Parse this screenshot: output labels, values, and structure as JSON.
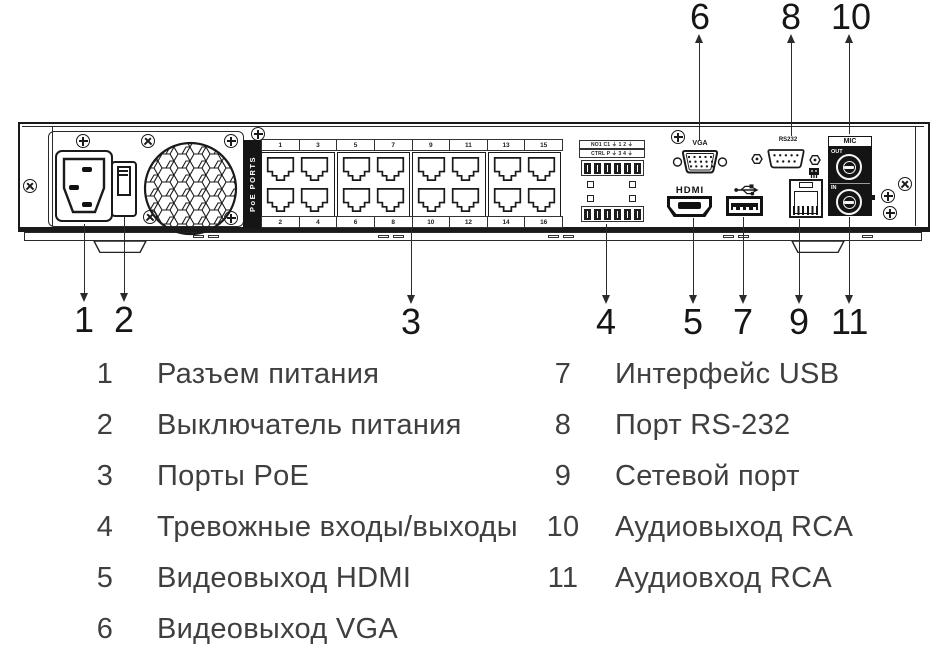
{
  "figure": {
    "type": "nvr-rear-panel-diagram",
    "device_labels": {
      "poe_ports": "PoE PORTS",
      "poe_top": [
        "1",
        "3",
        "5",
        "7",
        "9",
        "11",
        "13",
        "15"
      ],
      "poe_bottom": [
        "2",
        "4",
        "6",
        "8",
        "10",
        "12",
        "14",
        "16"
      ],
      "alarm_row1": "NO1 C1 ⏚  1 2 ⏚",
      "alarm_row2": "CTRL P ⏚  3 4 ⏚",
      "vga": "VGA",
      "rs232": "RS232",
      "hdmi": "HDMI",
      "mic": "MIC",
      "mic_out": "OUT",
      "mic_in": "IN"
    },
    "callouts": {
      "top": [
        "6",
        "8",
        "10"
      ],
      "bottom": [
        "1",
        "2",
        "3",
        "4",
        "5",
        "7",
        "9",
        "11"
      ]
    }
  },
  "legend": {
    "left": [
      {
        "num": "1",
        "label": "Разъем питания"
      },
      {
        "num": "2",
        "label": "Выключатель питания"
      },
      {
        "num": "3",
        "label": "Порты PoE"
      },
      {
        "num": "4",
        "label": "Тревожные входы/выходы"
      },
      {
        "num": "5",
        "label": "Видеовыход HDMI"
      },
      {
        "num": "6",
        "label": "Видеовыход VGA"
      }
    ],
    "right": [
      {
        "num": "7",
        "label": "Интерфейс USB"
      },
      {
        "num": "8",
        "label": "Порт RS-232"
      },
      {
        "num": "9",
        "label": "Сетевой порт"
      },
      {
        "num": "10",
        "label": "Аудиовыход RCA"
      },
      {
        "num": "11",
        "label": "Аудиовход RCA"
      }
    ]
  },
  "colors": {
    "line": "#1a1a1a",
    "legend_text": "#3f3f3f",
    "panel_bg": "#ffffff",
    "black_fill": "#141414"
  }
}
